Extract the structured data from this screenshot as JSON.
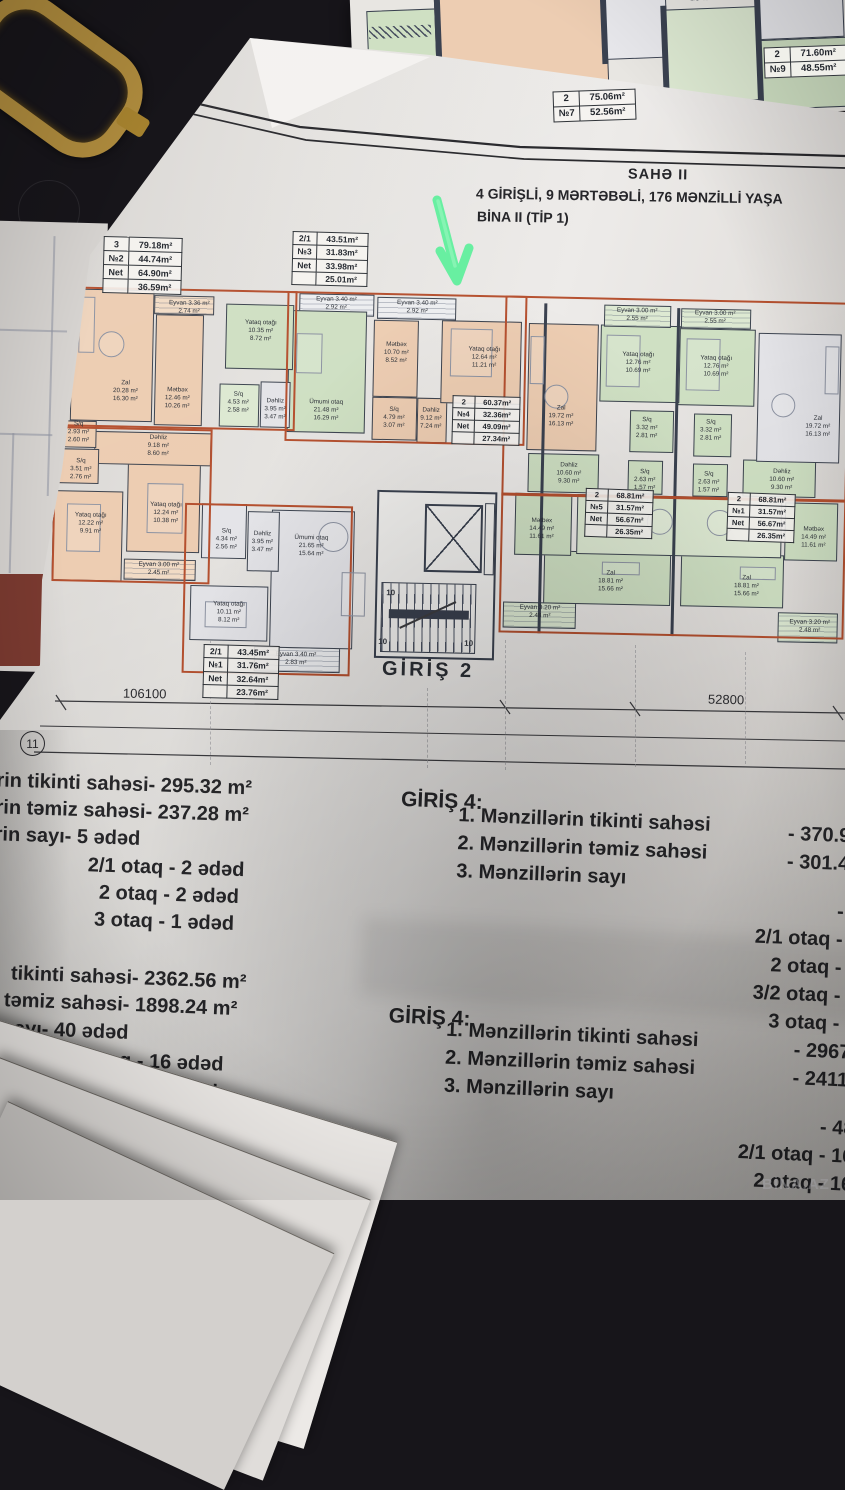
{
  "header": {
    "line1": "SAHƏ II",
    "line2": "4 GİRİŞLİ, 9 MƏRTƏBƏLİ, 176 MƏNZİLLİ  YAŞA",
    "line3": "BİNA II (TİP 1)"
  },
  "top_sheet": {
    "so_label": "S/O 4.88 m²"
  },
  "plan": {
    "entrance_label": "GİRİŞ 2",
    "dim_left": "106100",
    "dim_right": "52800",
    "sheet_number": "11",
    "stair_numbers": [
      {
        "t": "10",
        "x": 341,
        "y": 313
      },
      {
        "t": "10",
        "x": 334,
        "y": 362
      },
      {
        "t": "10",
        "x": 420,
        "y": 362
      }
    ],
    "rooms": [
      {
        "b": [
          21,
          20,
          82,
          132
        ],
        "f": "p"
      },
      {
        "b": [
          105,
          44,
          48,
          111
        ],
        "f": "p"
      },
      {
        "b": [
          103,
          25,
          60,
          19
        ],
        "f": "pl",
        "h": 1
      },
      {
        "b": [
          175,
          32,
          68,
          65
        ],
        "f": "g"
      },
      {
        "b": [
          170,
          112,
          40,
          43
        ],
        "f": "gl"
      },
      {
        "b": [
          211,
          109,
          30,
          46
        ],
        "f": "w"
      },
      {
        "b": [
          10,
          152,
          38,
          27
        ],
        "f": "p"
      },
      {
        "b": [
          10,
          180,
          41,
          35
        ],
        "f": "p"
      },
      {
        "b": [
          46,
          162,
          117,
          33
        ],
        "f": "p"
      },
      {
        "b": [
          6,
          222,
          70,
          90
        ],
        "f": "p"
      },
      {
        "b": [
          80,
          190,
          73,
          92
        ],
        "f": "p"
      },
      {
        "b": [
          78,
          289,
          72,
          21
        ],
        "f": "pl",
        "h": 1
      },
      {
        "b": [
          155,
          232,
          45,
          55
        ],
        "f": "w"
      },
      {
        "b": [
          201,
          239,
          32,
          60
        ],
        "f": "w"
      },
      {
        "b": [
          145,
          314,
          78,
          55
        ],
        "f": "w"
      },
      {
        "b": [
          238,
          37,
          78,
          122
        ],
        "f": "g"
      },
      {
        "b": [
          248,
          20,
          75,
          22
        ],
        "f": "wl",
        "h": 1
      },
      {
        "b": [
          326,
          22,
          79,
          22
        ],
        "f": "wl",
        "h": 1
      },
      {
        "b": [
          323,
          45,
          45,
          77
        ],
        "f": "p"
      },
      {
        "b": [
          391,
          44,
          80,
          83
        ],
        "f": "p"
      },
      {
        "b": [
          323,
          122,
          45,
          43
        ],
        "f": "p"
      },
      {
        "b": [
          368,
          122,
          30,
          45
        ],
        "f": "p"
      },
      {
        "b": [
          225,
          237,
          83,
          138
        ],
        "f": "w"
      },
      {
        "b": [
          210,
          374,
          86,
          25
        ],
        "f": "wl",
        "h": 1
      },
      {
        "b": [
          478,
          45,
          70,
          127
        ],
        "f": "p"
      },
      {
        "b": [
          553,
          25,
          67,
          22
        ],
        "f": "gl",
        "h": 1
      },
      {
        "b": [
          630,
          27,
          70,
          20
        ],
        "f": "gl",
        "h": 1
      },
      {
        "b": [
          550,
          45,
          80,
          77
        ],
        "f": "g"
      },
      {
        "b": [
          628,
          47,
          77,
          77
        ],
        "f": "g"
      },
      {
        "b": [
          581,
          130,
          44,
          42
        ],
        "f": "g"
      },
      {
        "b": [
          645,
          132,
          38,
          43
        ],
        "f": "g"
      },
      {
        "b": [
          708,
          50,
          83,
          129
        ],
        "f": "w"
      },
      {
        "b": [
          480,
          175,
          71,
          39
        ],
        "f": "g"
      },
      {
        "b": [
          695,
          177,
          73,
          37
        ],
        "f": "g"
      },
      {
        "b": [
          580,
          180,
          35,
          34
        ],
        "f": "g"
      },
      {
        "b": [
          645,
          182,
          35,
          33
        ],
        "f": "g"
      },
      {
        "b": [
          468,
          215,
          57,
          62
        ],
        "f": "g"
      },
      {
        "b": [
          738,
          219,
          53,
          58
        ],
        "f": "g"
      },
      {
        "b": [
          530,
          215,
          205,
          60
        ],
        "f": "gl"
      },
      {
        "b": [
          498,
          272,
          127,
          53
        ],
        "f": "g"
      },
      {
        "b": [
          635,
          272,
          103,
          53
        ],
        "f": "g"
      },
      {
        "b": [
          458,
          324,
          73,
          26
        ],
        "f": "gl",
        "h": 1
      },
      {
        "b": [
          733,
          329,
          60,
          30
        ],
        "f": "gl",
        "h": 1
      }
    ],
    "room_labels": [
      {
        "x": 76,
        "y": 122,
        "l": [
          "Zal",
          "20.28 m²",
          "16.30 m²"
        ]
      },
      {
        "x": 138,
        "y": 37,
        "l": [
          "Eyvan  3.36 m²",
          "2.74 m²"
        ]
      },
      {
        "x": 128,
        "y": 128,
        "l": [
          "Mətbəx",
          "12.46 m²",
          "10.26 m²"
        ]
      },
      {
        "x": 210,
        "y": 59,
        "l": [
          "Yataq otağı",
          "10.35 m²",
          "8.72 m²"
        ]
      },
      {
        "x": 189,
        "y": 131,
        "l": [
          "S/q",
          "4.53 m²",
          "2.58 m²"
        ]
      },
      {
        "x": 226,
        "y": 137,
        "l": [
          "Dəhliz",
          "3.95 m²",
          "3.47 m²"
        ]
      },
      {
        "x": 30,
        "y": 164,
        "l": [
          "S/q",
          "2.93 m²",
          "2.60 m²"
        ]
      },
      {
        "x": 33,
        "y": 201,
        "l": [
          "S/q",
          "3.51 m²",
          "2.76 m²"
        ]
      },
      {
        "x": 110,
        "y": 176,
        "l": [
          "Dəhliz",
          "9.18 m²",
          "8.60 m²"
        ]
      },
      {
        "x": 44,
        "y": 255,
        "l": [
          "Yataq otağı",
          "12.22 m²",
          "9.91 m²"
        ]
      },
      {
        "x": 119,
        "y": 243,
        "l": [
          "Yataq otağı",
          "12.24 m²",
          "10.38 m²"
        ]
      },
      {
        "x": 113,
        "y": 299,
        "l": [
          "Eyvan  3.00 m²",
          "2.45 m²"
        ]
      },
      {
        "x": 180,
        "y": 268,
        "l": [
          "S/q",
          "4.34 m²",
          "2.56 m²"
        ]
      },
      {
        "x": 216,
        "y": 270,
        "l": [
          "Dəhliz",
          "3.95 m²",
          "3.47 m²"
        ]
      },
      {
        "x": 184,
        "y": 341,
        "l": [
          "Yataq otağı",
          "10.11 m²",
          "8.12 m²"
        ]
      },
      {
        "x": 277,
        "y": 137,
        "l": [
          "Ümumi otaq",
          "21.48 m²",
          "16.29 m²"
        ]
      },
      {
        "x": 285,
        "y": 30,
        "l": [
          "Eyvan  3.40 m²",
          "2.92 m²"
        ]
      },
      {
        "x": 366,
        "y": 32,
        "l": [
          "Eyvan  3.40 m²",
          "2.92 m²"
        ]
      },
      {
        "x": 346,
        "y": 78,
        "l": [
          "Mətbəx",
          "10.70 m²",
          "8.52 m²"
        ]
      },
      {
        "x": 434,
        "y": 81,
        "l": [
          "Yataq otağı",
          "12.64 m²",
          "11.21 m²"
        ]
      },
      {
        "x": 345,
        "y": 143,
        "l": [
          "S/q",
          "4.79 m²",
          "3.07 m²"
        ]
      },
      {
        "x": 382,
        "y": 143,
        "l": [
          "Dəhliz",
          "9.12 m²",
          "7.24 m²"
        ]
      },
      {
        "x": 265,
        "y": 273,
        "l": [
          "Ümumi otaq",
          "21.65 m²",
          "15.64 m²"
        ]
      },
      {
        "x": 252,
        "y": 386,
        "l": [
          "Eyvan  3.40 m²",
          "2.83 m²"
        ]
      },
      {
        "x": 512,
        "y": 138,
        "l": [
          "Zal",
          "19.72 m²",
          "16.13 m²"
        ]
      },
      {
        "x": 586,
        "y": 35,
        "l": [
          "Eyvan  3.00 m²",
          "2.55 m²"
        ]
      },
      {
        "x": 664,
        "y": 36,
        "l": [
          "Eyvan  3.00 m²",
          "2.55 m²"
        ]
      },
      {
        "x": 588,
        "y": 83,
        "l": [
          "Yataq otağı",
          "12.76 m²",
          "10.69 m²"
        ]
      },
      {
        "x": 666,
        "y": 85,
        "l": [
          "Yataq otağı",
          "12.76 m²",
          "10.69 m²"
        ]
      },
      {
        "x": 598,
        "y": 148,
        "l": [
          "S/q",
          "3.32 m²",
          "2.81 m²"
        ]
      },
      {
        "x": 662,
        "y": 149,
        "l": [
          "S/q",
          "3.32 m²",
          "2.81 m²"
        ]
      },
      {
        "x": 769,
        "y": 143,
        "l": [
          "Zal",
          "19.72 m²",
          "16.13 m²"
        ]
      },
      {
        "x": 521,
        "y": 195,
        "l": [
          "Dəhliz",
          "10.60 m²",
          "9.30 m²"
        ]
      },
      {
        "x": 734,
        "y": 197,
        "l": [
          "Dəhliz",
          "10.60 m²",
          "9.30 m²"
        ]
      },
      {
        "x": 597,
        "y": 200,
        "l": [
          "S/q",
          "2.63 m²",
          "1.57 m²"
        ]
      },
      {
        "x": 661,
        "y": 201,
        "l": [
          "S/q",
          "2.63 m²",
          "1.57 m²"
        ]
      },
      {
        "x": 495,
        "y": 251,
        "l": [
          "Mətbəx",
          "14.49 m²",
          "11.61 m²"
        ]
      },
      {
        "x": 767,
        "y": 254,
        "l": [
          "Mətbəx",
          "14.49 m²",
          "11.61 m²"
        ]
      },
      {
        "x": 565,
        "y": 302,
        "l": [
          "Zal",
          "18.81 m²",
          "15.66 m²"
        ]
      },
      {
        "x": 701,
        "y": 304,
        "l": [
          "Zal",
          "18.81 m²",
          "15.66 m²"
        ]
      },
      {
        "x": 495,
        "y": 334,
        "l": [
          "Eyvan  3.20 m²",
          "2.48 m²"
        ]
      },
      {
        "x": 765,
        "y": 343,
        "l": [
          "Eyvan  3.20 m²",
          "2.48 m²"
        ]
      }
    ],
    "furniture": [
      {
        "b": [
          28,
          28,
          16,
          56
        ],
        "s": "r"
      },
      {
        "b": [
          48,
          62,
          26,
          26
        ],
        "s": "c"
      },
      {
        "b": [
          20,
          235,
          34,
          48
        ],
        "s": "r"
      },
      {
        "b": [
          100,
          213,
          36,
          50
        ],
        "s": "r"
      },
      {
        "b": [
          160,
          330,
          42,
          26
        ],
        "s": "r"
      },
      {
        "b": [
          400,
          52,
          42,
          48
        ],
        "s": "r"
      },
      {
        "b": [
          480,
          58,
          14,
          48
        ],
        "s": "r"
      },
      {
        "b": [
          495,
          106,
          24,
          24
        ],
        "s": "c"
      },
      {
        "b": [
          556,
          55,
          34,
          52
        ],
        "s": "r"
      },
      {
        "b": [
          636,
          57,
          34,
          52
        ],
        "s": "r"
      },
      {
        "b": [
          775,
          62,
          14,
          48
        ],
        "s": "r"
      },
      {
        "b": [
          722,
          110,
          24,
          24
        ],
        "s": "c"
      },
      {
        "b": [
          272,
          248,
          30,
          30
        ],
        "s": "c"
      },
      {
        "b": [
          296,
          298,
          24,
          44
        ],
        "s": "r"
      },
      {
        "b": [
          556,
          282,
          38,
          13
        ],
        "s": "r"
      },
      {
        "b": [
          694,
          284,
          36,
          13
        ],
        "s": "r"
      },
      {
        "b": [
          246,
          60,
          26,
          40
        ],
        "s": "r"
      },
      {
        "b": [
          600,
          228,
          26,
          26
        ],
        "s": "c"
      },
      {
        "b": [
          660,
          228,
          26,
          26
        ],
        "s": "c"
      }
    ],
    "tables": [
      {
        "x": 103,
        "y": 237,
        "fs": 9,
        "rot": 1.5,
        "layer": "sheet",
        "rows": [
          [
            "3",
            "79.18m²"
          ],
          [
            "№2",
            "44.74m²"
          ],
          [
            "Net",
            "64.90m²"
          ],
          [
            "",
            "36.59m²"
          ]
        ]
      },
      {
        "x": 292,
        "y": 232,
        "fs": 8.5,
        "rot": 1.5,
        "layer": "sheet",
        "rows": [
          [
            "2/1",
            "43.51m²"
          ],
          [
            "№3",
            "31.83m²"
          ],
          [
            "Net",
            "33.98m²"
          ],
          [
            "",
            "25.01m²"
          ]
        ]
      },
      {
        "x": 452,
        "y": 396,
        "fs": 7.5,
        "rot": 1.5,
        "layer": "sheet",
        "rows": [
          [
            "2",
            "60.37m²"
          ],
          [
            "№4",
            "32.36m²"
          ],
          [
            "Net",
            "49.09m²"
          ],
          [
            "",
            "27.34m²"
          ]
        ]
      },
      {
        "x": 585,
        "y": 489,
        "fs": 7.5,
        "rot": 2,
        "layer": "sheet",
        "rows": [
          [
            "2",
            "68.81m²"
          ],
          [
            "№5",
            "31.57m²"
          ],
          [
            "Net",
            "56.67m²"
          ],
          [
            "",
            "26.35m²"
          ]
        ]
      },
      {
        "x": 727,
        "y": 493,
        "fs": 7.5,
        "rot": 2,
        "layer": "sheet",
        "rows": [
          [
            "2",
            "68.81m²"
          ],
          [
            "№1",
            "31.57m²"
          ],
          [
            "Net",
            "56.67m²"
          ],
          [
            "",
            "26.35m²"
          ]
        ]
      },
      {
        "x": 203,
        "y": 645,
        "fs": 8.5,
        "rot": 1.5,
        "layer": "sheet",
        "rows": [
          [
            "2/1",
            "43.45m²"
          ],
          [
            "№1",
            "31.76m²"
          ],
          [
            "Net",
            "32.64m²"
          ],
          [
            "",
            "23.76m²"
          ]
        ]
      },
      {
        "x": 553,
        "y": 90,
        "fs": 9.5,
        "rot": -2,
        "layer": "scene",
        "rows": [
          [
            "2",
            "75.06m²"
          ],
          [
            "№7",
            "52.56m²"
          ]
        ]
      },
      {
        "x": 764,
        "y": 46,
        "fs": 9.5,
        "rot": -2,
        "layer": "scene",
        "rows": [
          [
            "2",
            "71.60m²"
          ],
          [
            "№9",
            "48.55m²"
          ]
        ]
      }
    ]
  },
  "stats": {
    "a": {
      "rows": [
        {
          "l": "rin tikinti sahəsi",
          "v": "- 295.32 m²"
        },
        {
          "l": "rin təmiz sahəsi",
          "v": "- 237.28 m²"
        },
        {
          "l": "rin sayı",
          "v": "- 5 ədəd"
        },
        {
          "l": "",
          "v": "2/1 otaq - 2 ədəd"
        },
        {
          "l": "",
          "v": "2 otaq - 2 ədəd"
        },
        {
          "l": "",
          "v": "3 otaq - 1 ədəd"
        }
      ]
    },
    "b": {
      "heading": "GİRİŞ 4:",
      "items": [
        {
          "l": "1. Mənzillərin tikinti sahəsi",
          "v": "- 370.9"
        },
        {
          "l": "2. Mənzillərin təmiz sahəsi",
          "v": "- 301.4"
        },
        {
          "l": "3. Mənzillərin sayı",
          "v": ""
        }
      ],
      "right": [
        "- 6 ə",
        "2/1 otaq - 2 ə",
        "2 otaq - 2 ə",
        "3/2 otaq - 1 ə",
        "3 otaq - 1 ə"
      ]
    },
    "c": {
      "rows": [
        {
          "l": "tikinti sahəsi",
          "v": "- 2362.56 m²"
        },
        {
          "l": "təmiz sahəsi",
          "v": "- 1898.24 m²"
        },
        {
          "l": "sayı",
          "v": "- 40 ədəd"
        },
        {
          "l": "",
          "v": "2/1 otaq - 16 ədəd"
        },
        {
          "l": "",
          "v": "2 otaq - 16 ədəd"
        },
        {
          "l": "",
          "v": "3 otaq - 8 ədəd"
        }
      ]
    },
    "d": {
      "heading": "GİRİŞ 4:",
      "items": [
        {
          "l": "1. Mənzillərin tikinti sahəsi",
          "v": "- 2967"
        },
        {
          "l": "2. Mənzillərin təmiz sahəsi",
          "v": "- 2411"
        },
        {
          "l": "3. Mənzillərin sayı",
          "v": ""
        }
      ],
      "right": [
        "- 48",
        "2/1 otaq - 16",
        "2 otaq - 16",
        "3/2 otaq - 8"
      ]
    }
  },
  "watermark": "BİNA.AZ",
  "colors": {
    "peach": "#edcdb2",
    "peach_light": "#f2dcc6",
    "green": "#cfe0c3",
    "green_light": "#dde9d2",
    "grey_room": "#e4e4e8",
    "outline_orange": "#b5502f",
    "walls": "#3d4450",
    "arrow_green": "#68efa1"
  }
}
